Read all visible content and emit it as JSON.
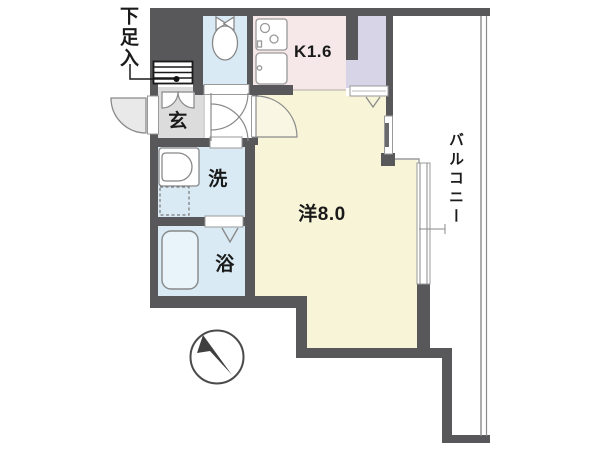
{
  "floorplan": {
    "rooms": {
      "shoe_storage_label": "下足入",
      "entrance_label": "玄",
      "kitchen_label": "K1.6",
      "washroom_label": "洗",
      "bathroom_label": "浴",
      "western_room_label": "洋8.0",
      "balcony_label": "バルコニー"
    },
    "colors": {
      "wall": "#58585a",
      "water_room_floor": "#d9eaf4",
      "bathtub": "#e9f3fa",
      "kitchen_floor": "#f6e8e9",
      "western_room_floor": "#f7f4d8",
      "closet_floor": "#d8d4e8",
      "entrance_floor": "#dcdcdc",
      "hall_floor": "#ffffff",
      "door_arc_fill": "#e9e9e9",
      "outline": "#8a8a8a"
    }
  }
}
